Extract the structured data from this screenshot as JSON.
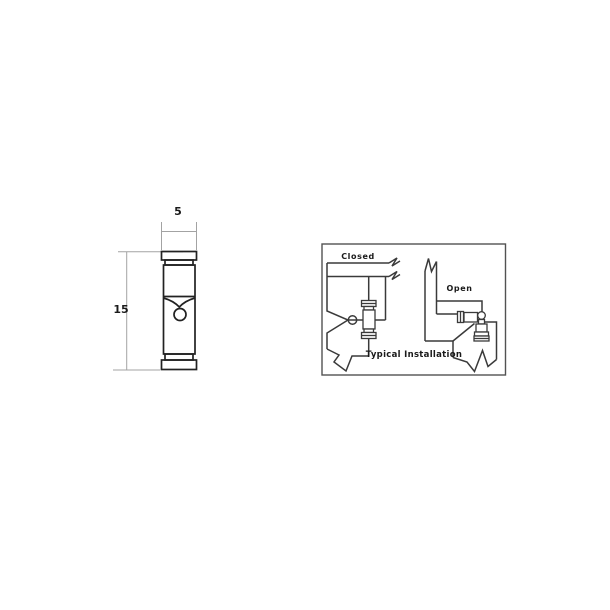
{
  "drawing": {
    "width_dim_label": "5",
    "height_dim_label": "15"
  },
  "inset": {
    "closed_label": "Closed",
    "open_label": "Open",
    "caption": "Typical Installation"
  },
  "colors": {
    "bg": "#ffffff",
    "line": "#222222",
    "pipe": "#3a3a3a",
    "dim": "#a3a3a3",
    "text": "#1a1a1a",
    "border": "#525252"
  }
}
